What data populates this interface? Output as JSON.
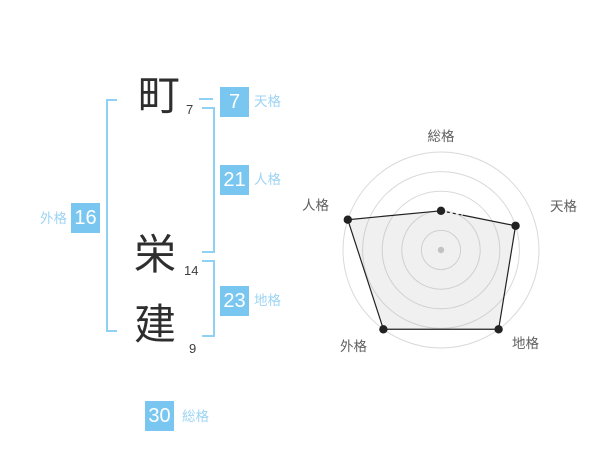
{
  "name_panel": {
    "characters": [
      {
        "char": "町",
        "strokes": "7"
      },
      {
        "char": "栄",
        "strokes": "14"
      },
      {
        "char": "建",
        "strokes": "9"
      }
    ],
    "scores": [
      {
        "id": "tenkaku",
        "label": "天格",
        "value": "7"
      },
      {
        "id": "jinkaku",
        "label": "人格",
        "value": "21"
      },
      {
        "id": "chikaku",
        "label": "地格",
        "value": "23"
      },
      {
        "id": "gaikaku",
        "label": "外格",
        "value": "16"
      },
      {
        "id": "soukaku",
        "label": "総格",
        "value": "30"
      }
    ]
  },
  "chart_data": {
    "type": "radar",
    "axes": [
      "総格",
      "天格",
      "地格",
      "外格",
      "人格"
    ],
    "series": [
      {
        "name": "score",
        "values": [
          2,
          4,
          5,
          5,
          5
        ]
      }
    ],
    "max": 5,
    "rings": 5,
    "grid": "concentric-circles",
    "legend": false
  },
  "colors": {
    "accent_box": "#79c7f1",
    "accent_label": "#9dd4f4",
    "bracket": "#8fd0f5",
    "box_number": "#ffffff",
    "kanji": "#2e2e2e",
    "ring": "#d9d9d9",
    "center_dot": "#c9c9c9",
    "polygon_line": "#222222",
    "polygon_fill": "rgba(160,160,160,0.16)",
    "axis_label": "#5f5f5f"
  }
}
